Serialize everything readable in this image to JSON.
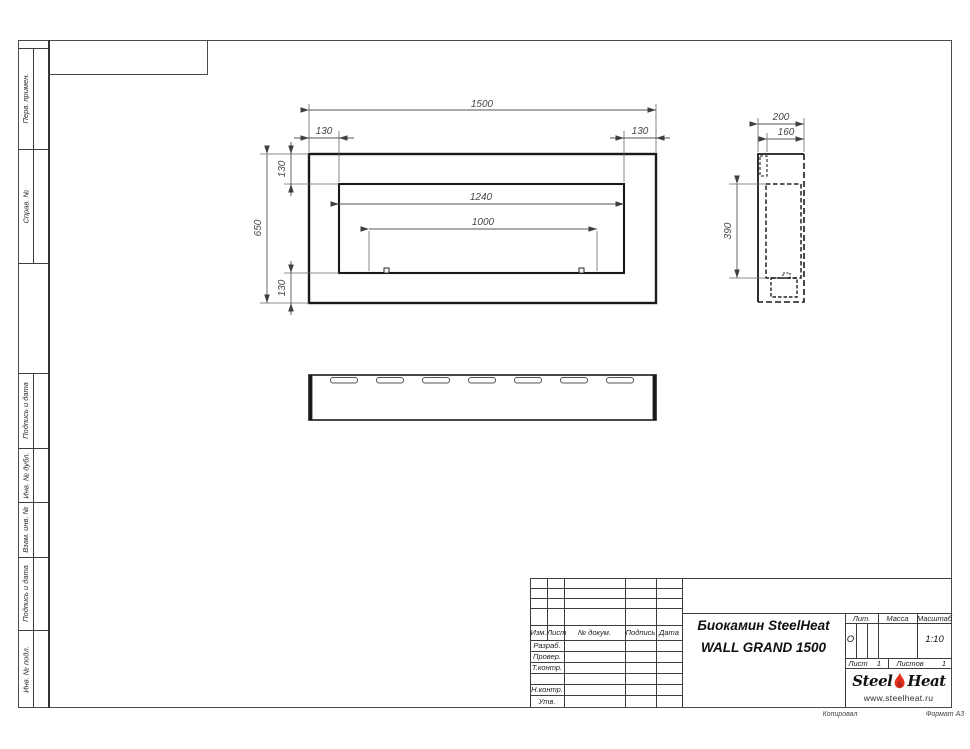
{
  "sheet": {
    "footer": {
      "copied": "Копировал",
      "format": "Формат А3"
    }
  },
  "margin_boxes": {
    "labels": [
      "Перв. примен.",
      "Справ. №",
      "Подпись и дата",
      "Инв. № дубл.",
      "Взам. инв. №",
      "Подпись и дата",
      "Инв. № подл."
    ]
  },
  "views": {
    "front": {
      "dims": {
        "overall_width": "1500",
        "left_offset": "130",
        "right_offset": "130",
        "overall_height": "650",
        "top_offset": "130",
        "bottom_offset": "130",
        "opening_width": "1240",
        "burner_spacing": "1000"
      }
    },
    "side": {
      "dims": {
        "depth": "200",
        "inner_depth": "160",
        "opening_height": "390"
      }
    },
    "bottom": {
      "vent_slots": 7
    }
  },
  "title_block": {
    "change_header": {
      "izm": "Изм.",
      "list": "Лист",
      "doc": "№ докум.",
      "sign": "Подпись",
      "date": "Дата"
    },
    "roles": {
      "developed": "Разраб.",
      "checked": "Провер.",
      "tcontrol": "Т.контр.",
      "ncontrol": "Н.контр.",
      "approved": "Утв."
    },
    "doc_title_line1": "Биокамин SteelHeat",
    "doc_title_line2": "WALL GRAND 1500",
    "lit": {
      "label": "Лит.",
      "value": "О"
    },
    "mass": {
      "label": "Масса",
      "value": ""
    },
    "scale": {
      "label": "Масштаб",
      "value": "1:10"
    },
    "sheet": {
      "label": "Лист",
      "value": "1"
    },
    "sheets": {
      "label": "Листов",
      "value": "1"
    },
    "logo": {
      "word1": "Steel",
      "word2": "Heat",
      "site": "www.steelheat.ru",
      "flame_color": "#e23120"
    }
  }
}
